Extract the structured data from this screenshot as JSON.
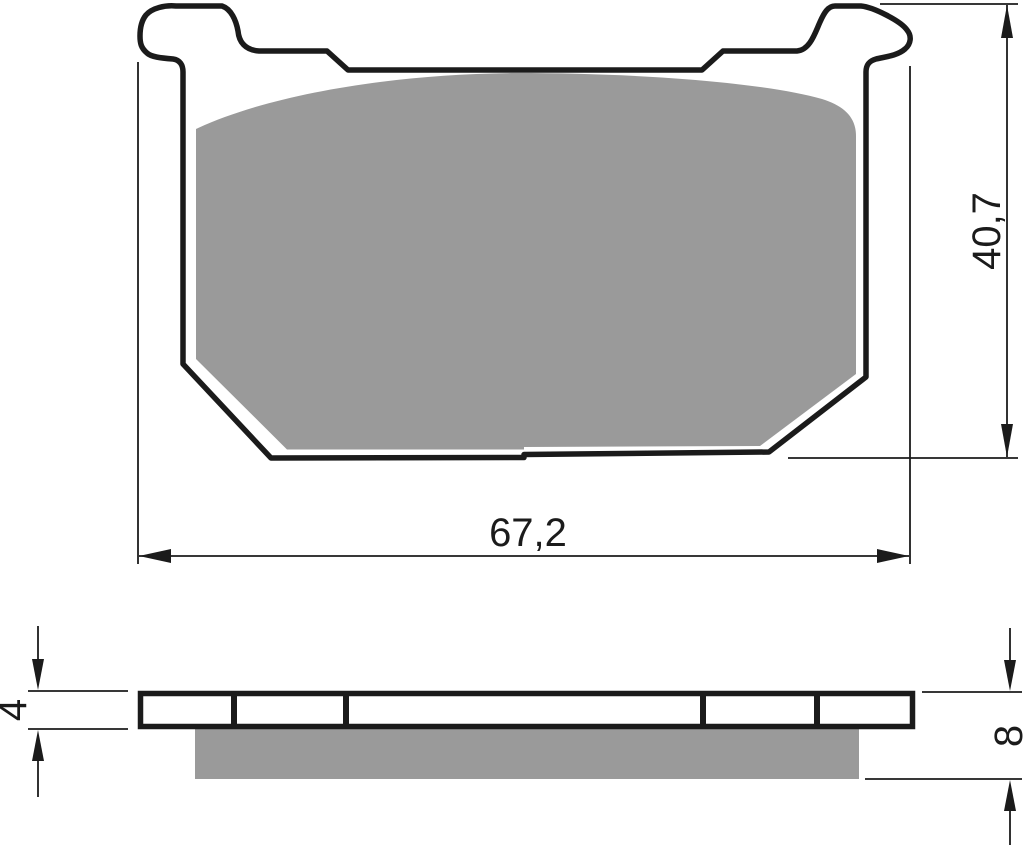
{
  "drawing": {
    "type": "brake-pad-technical-drawing",
    "colors": {
      "line": "#1b1b1b",
      "friction_material": "#9a9a9a",
      "background": "#ffffff"
    },
    "top_view": {
      "width_label": "67,2",
      "height_label": "40,7"
    },
    "side_view": {
      "backplate_thickness_label": "4",
      "total_thickness_label": "8",
      "segment_count": 5
    }
  }
}
